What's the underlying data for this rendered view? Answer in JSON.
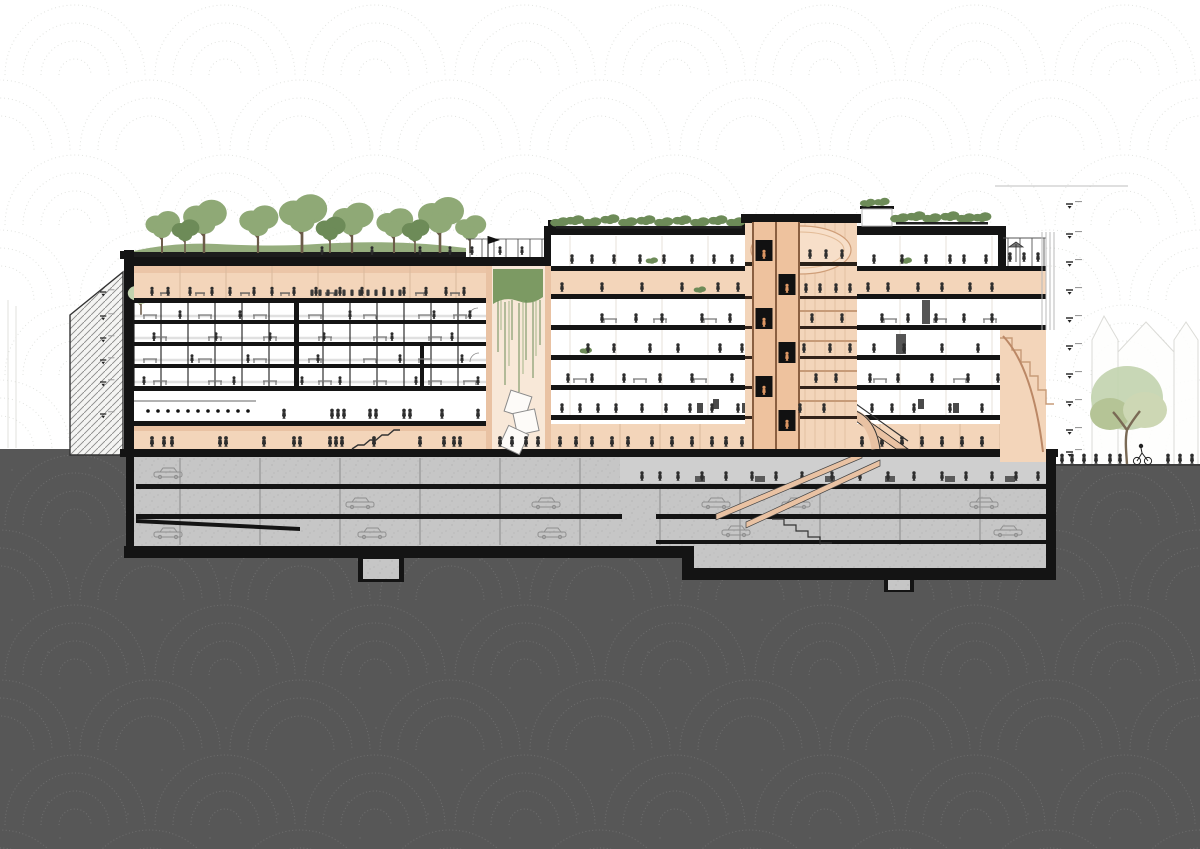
{
  "colors": {
    "background": "#ffffff",
    "sky_line": "#c3c7c0",
    "earth": "#575757",
    "earth_dot": "#707070",
    "cut": "#141414",
    "wall_peach": "#f3d5ba",
    "wall_peach_dark": "#e9c2a3",
    "wall_peach_pale": "#f8e8d8",
    "vault_peach": "#f7dfc9",
    "accent_orange": "#dd9764",
    "concrete": "#c6c6c6",
    "concrete_dark": "#b2b2b2",
    "concrete_light": "#cfcfcf",
    "foliage": "#8fa976",
    "foliage_dark": "#6d8b58",
    "foliage_pale": "#c2d3ae",
    "vine": "#7c9a63",
    "figure": "#2e2e2e",
    "line_gray": "#9a9a9a",
    "hatch_line": "#8a8a8a"
  },
  "scene": {
    "type": "architectural-cross-section-illustration",
    "visible_text": "none (tiny level annotations illegible)",
    "left_block": {
      "floors_above_ground": 7,
      "office_floors": 4,
      "roof_garden": true,
      "rooftop_trees": 11
    },
    "right_block": {
      "floors_above_ground": 6,
      "roof_planters": true,
      "roof_terrace_right": true
    },
    "tower": {
      "elevator_shafts": 2,
      "elevator_cabs": 6,
      "vaulted_ceiling": true
    },
    "atrium": {
      "hanging_green_wall": true,
      "sculpture_cubes": 3
    },
    "basement": {
      "parking_levels": 3,
      "occupied_level": true,
      "cars_visible": 11,
      "escalators": 2
    },
    "context": {
      "neighbor_building_hatched_left": true,
      "background_houses_right": 3,
      "street_tree_right": 1,
      "level_tick_marks_left": 6,
      "level_tick_marks_right": 10,
      "tick_labels_legible": false
    }
  }
}
